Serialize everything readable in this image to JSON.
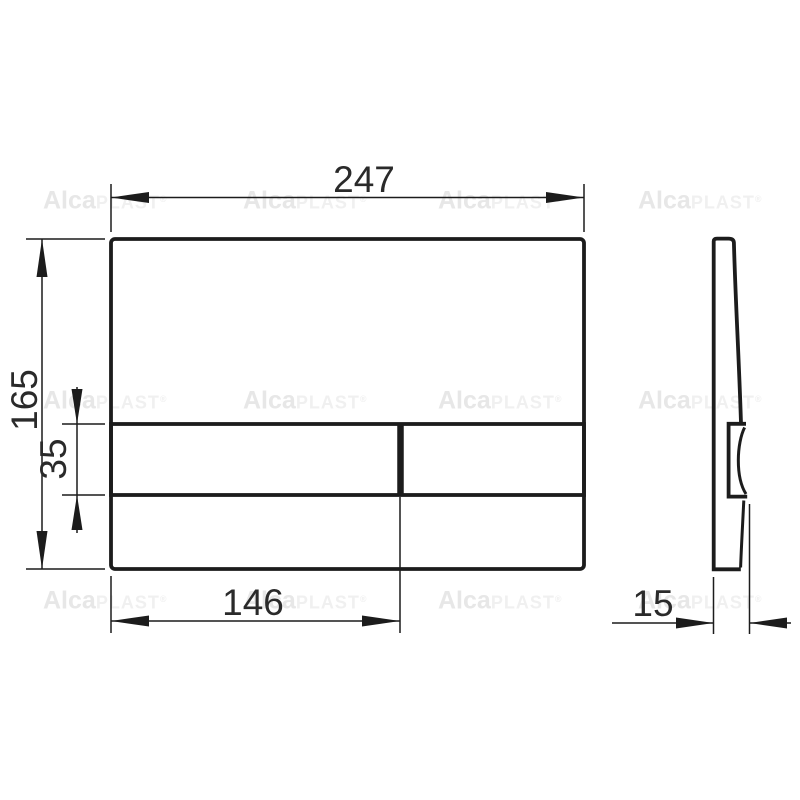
{
  "watermark": {
    "bold": "Alca",
    "light": "PLAST",
    "reg": "®"
  },
  "dimensions": {
    "plate_width": "247",
    "plate_height": "165",
    "button_height": "35",
    "button_width": "146",
    "thickness": "15"
  },
  "colors": {
    "background": "#ffffff",
    "line": "#1c1c1c",
    "label": "#2a2a2a",
    "watermark": "#eaeaea"
  }
}
